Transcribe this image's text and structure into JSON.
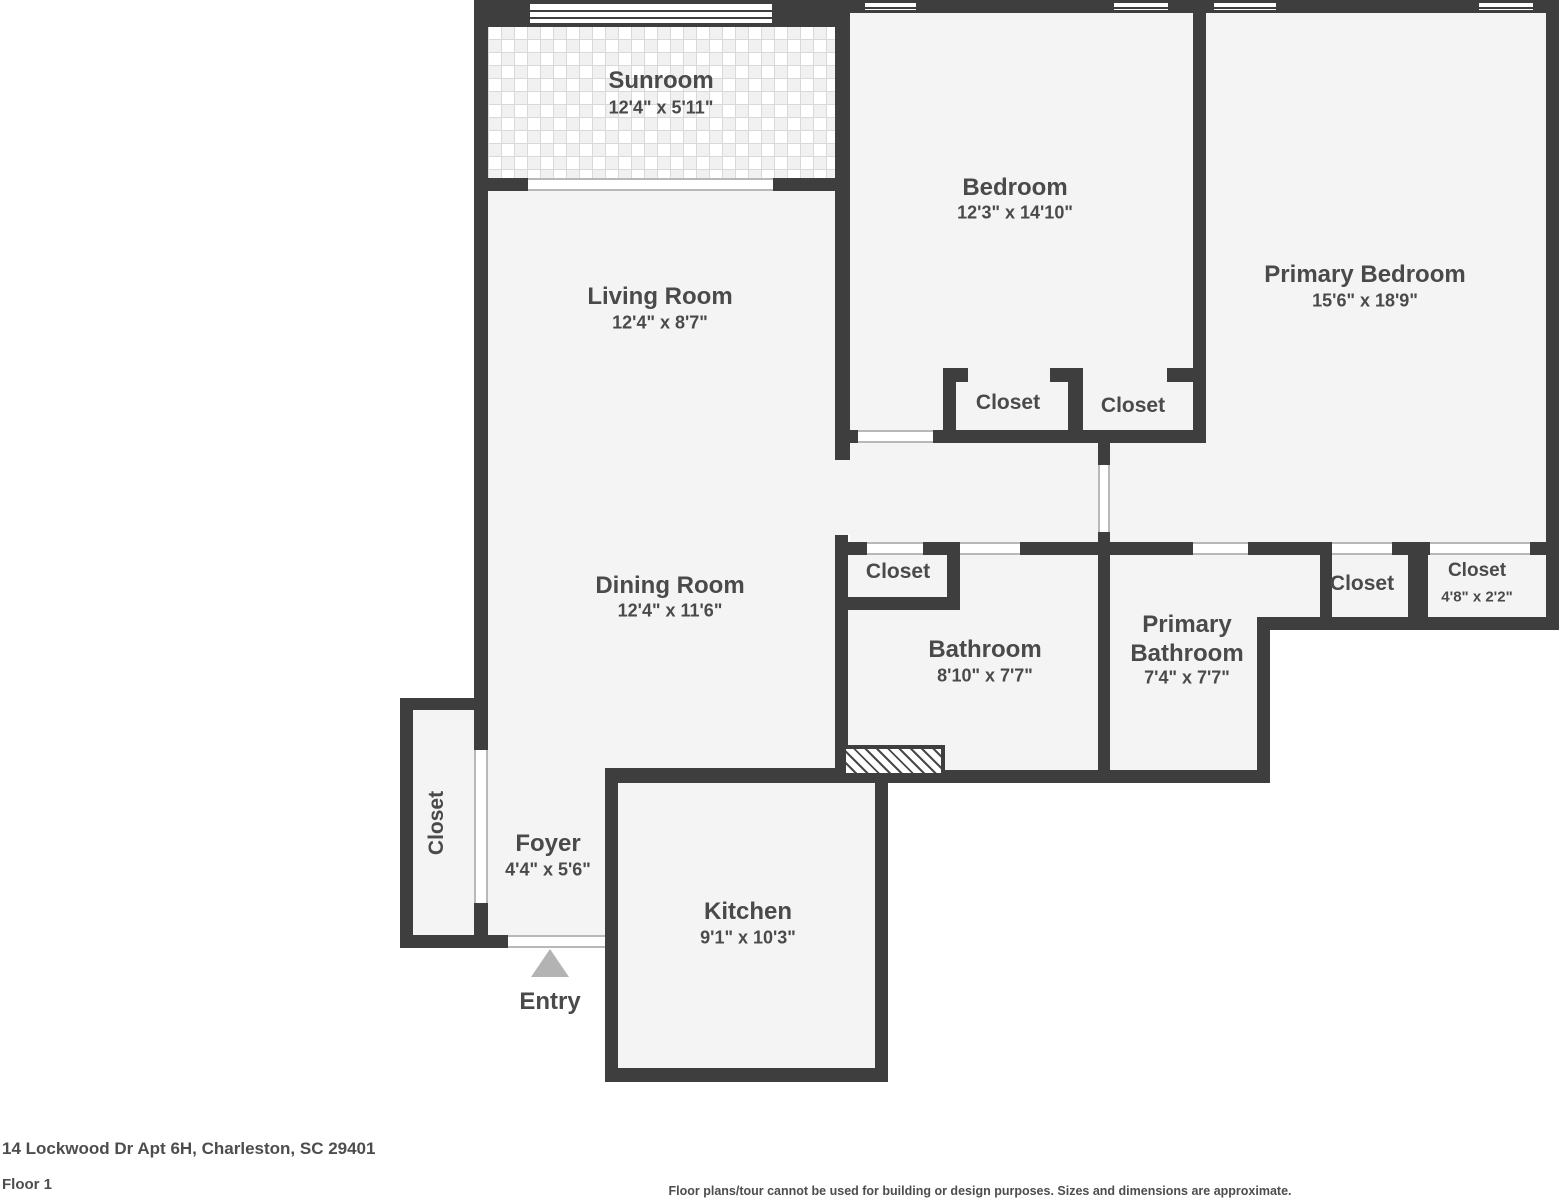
{
  "page": {
    "address": "14 Lockwood Dr Apt 6H, Charleston, SC 29401",
    "floor_label": "Floor 1",
    "disclaimer": "Floor plans/tour cannot be used for building or design purposes. Sizes and dimensions are approximate."
  },
  "colors": {
    "wall": "#3e3e3e",
    "floor": "#f4f4f4",
    "label_text": "#4a4a4a",
    "entry_arrow": "#b3b3b3",
    "door_opening_line": "#b8b8b8"
  },
  "rooms": {
    "sunroom": {
      "name": "Sunroom",
      "dims": "12'4\" x 5'11\""
    },
    "living_room": {
      "name": "Living Room",
      "dims": "12'4\" x 8'7\""
    },
    "dining_room": {
      "name": "Dining Room",
      "dims": "12'4\" x 11'6\""
    },
    "bedroom": {
      "name": "Bedroom",
      "dims": "12'3\" x 14'10\""
    },
    "primary_bedroom": {
      "name": "Primary Bedroom",
      "dims": "15'6\" x 18'9\""
    },
    "bathroom": {
      "name": "Bathroom",
      "dims": "8'10\" x 7'7\""
    },
    "primary_bathroom": {
      "name": "Primary Bathroom",
      "dims": "7'4\" x 7'7\""
    },
    "kitchen": {
      "name": "Kitchen",
      "dims": "9'1\" x 10'3\""
    },
    "foyer": {
      "name": "Foyer",
      "dims": "4'4\" x 5'6\""
    },
    "entry": {
      "name": "Entry"
    },
    "closet_bedroom_left": {
      "name": "Closet"
    },
    "closet_bedroom_right": {
      "name": "Closet"
    },
    "closet_hall": {
      "name": "Closet"
    },
    "closet_foyer": {
      "name": "Closet"
    },
    "closet_primary_left": {
      "name": "Closet"
    },
    "closet_primary_right": {
      "name": "Closet",
      "dims": "4'8\" x 2'2\""
    }
  }
}
